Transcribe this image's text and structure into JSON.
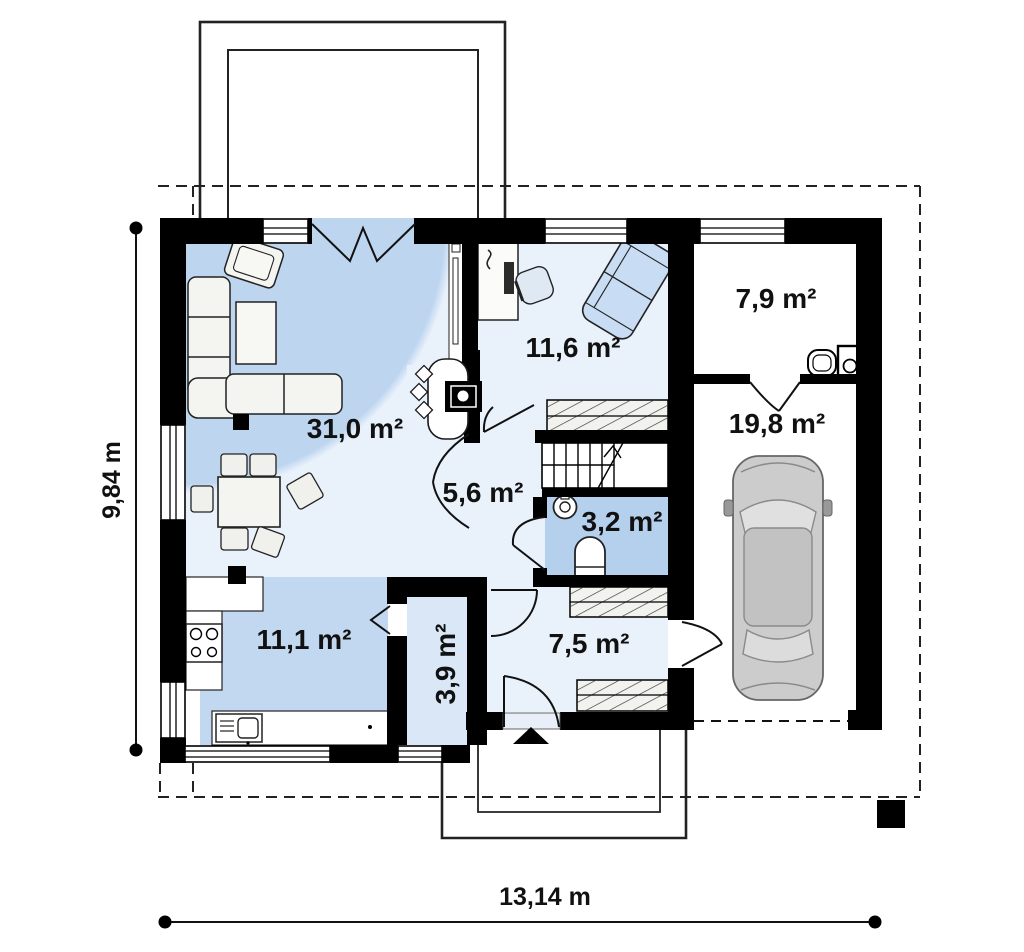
{
  "plan": {
    "type": "house-floor-plan",
    "rooms": [
      {
        "name": "living-room",
        "area": "31,0 m²"
      },
      {
        "name": "office",
        "area": "11,6 m²"
      },
      {
        "name": "utility-room",
        "area": "7,9 m²"
      },
      {
        "name": "garage",
        "area": "19,8 m²"
      },
      {
        "name": "hall",
        "area": "5,6 m²"
      },
      {
        "name": "wc",
        "area": "3,2 m²"
      },
      {
        "name": "kitchen",
        "area": "11,1 m²"
      },
      {
        "name": "pantry",
        "area": "3,9 m²"
      },
      {
        "name": "corridor",
        "area": "7,5 m²"
      }
    ],
    "dimensions": {
      "side": "9,84 m",
      "front": "13,14 m"
    },
    "colors": {
      "wall": "#000000",
      "living_dark": "#bdd5ef",
      "room_light": "#e9f1fb",
      "kitchen": "#c2d8f0",
      "wc": "#b5d0ed",
      "pantry": "#d9e7f7",
      "sofa_blue": "#c8ddf3",
      "car_body": "#cccccc"
    }
  }
}
